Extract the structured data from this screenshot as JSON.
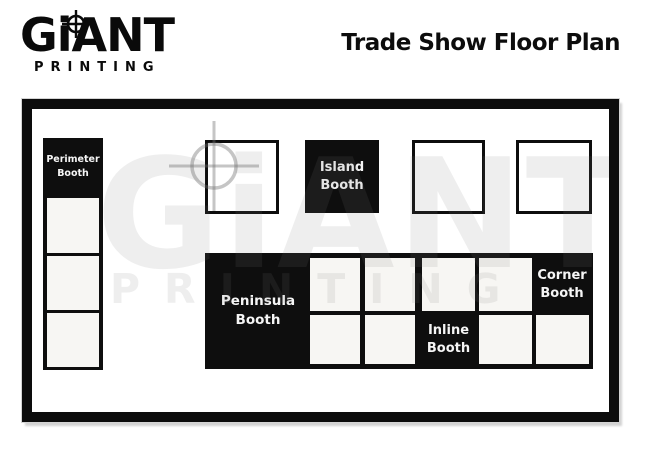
{
  "header": {
    "logo": {
      "word": "GiANT",
      "sub": "PRINTING"
    },
    "title": "Trade Show Floor Plan"
  },
  "watermark": {
    "word": "GiANT",
    "sub": "PRINTING"
  },
  "booths": {
    "perimeter": {
      "label": "Perimeter Booth"
    },
    "island": {
      "label": "Island Booth"
    },
    "peninsula": {
      "label": "Peninsula Booth"
    },
    "inline": {
      "label": "Inline Booth"
    },
    "corner": {
      "label": "Corner Booth"
    }
  },
  "colors": {
    "booth_black": "#0e0e0e",
    "cell_fill": "#f7f6f3",
    "frame_border": "#0c0c0c",
    "watermark_gray": "#f0f0f0",
    "crosshair_gray": "#c4c4c4"
  }
}
